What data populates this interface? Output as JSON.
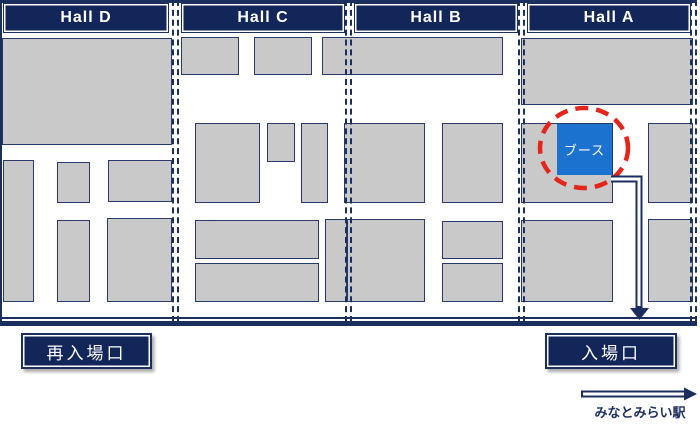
{
  "colors": {
    "navy": "#1b2f5e",
    "navy_fill": "#13265a",
    "booth_gray": "#c9c9c9",
    "booth_border": "#28396b",
    "highlight_blue": "#1c73cf",
    "highlight_red": "#e4251c"
  },
  "halls": [
    {
      "id": "hall-d",
      "label": "Hall D",
      "band": {
        "x": 3,
        "y": 3,
        "w": 166,
        "h": 30
      }
    },
    {
      "id": "hall-c",
      "label": "Hall C",
      "band": {
        "x": 181,
        "y": 3,
        "w": 164,
        "h": 30
      }
    },
    {
      "id": "hall-b",
      "label": "Hall B",
      "band": {
        "x": 354,
        "y": 3,
        "w": 164,
        "h": 30
      }
    },
    {
      "id": "hall-a",
      "label": "Hall A",
      "band": {
        "x": 527,
        "y": 3,
        "w": 164,
        "h": 30
      }
    }
  ],
  "booths": [
    {
      "x": 2,
      "y": 38,
      "w": 170,
      "h": 107
    },
    {
      "x": 3,
      "y": 160,
      "w": 31,
      "h": 142
    },
    {
      "x": 57,
      "y": 162,
      "w": 33,
      "h": 41
    },
    {
      "x": 57,
      "y": 220,
      "w": 33,
      "h": 82
    },
    {
      "x": 108,
      "y": 160,
      "w": 64,
      "h": 42
    },
    {
      "x": 107,
      "y": 218,
      "w": 65,
      "h": 84
    },
    {
      "x": 181,
      "y": 37,
      "w": 58,
      "h": 38
    },
    {
      "x": 254,
      "y": 37,
      "w": 58,
      "h": 38
    },
    {
      "x": 322,
      "y": 37,
      "w": 181,
      "h": 38
    },
    {
      "x": 195,
      "y": 123,
      "w": 65,
      "h": 80
    },
    {
      "x": 267,
      "y": 123,
      "w": 28,
      "h": 39
    },
    {
      "x": 301,
      "y": 123,
      "w": 27,
      "h": 80
    },
    {
      "x": 195,
      "y": 220,
      "w": 124,
      "h": 39
    },
    {
      "x": 195,
      "y": 263,
      "w": 124,
      "h": 39
    },
    {
      "x": 325,
      "y": 219,
      "w": 22,
      "h": 83
    },
    {
      "x": 344,
      "y": 123,
      "w": 81,
      "h": 80
    },
    {
      "x": 442,
      "y": 123,
      "w": 61,
      "h": 80
    },
    {
      "x": 347,
      "y": 219,
      "w": 78,
      "h": 83
    },
    {
      "x": 442,
      "y": 221,
      "w": 61,
      "h": 38
    },
    {
      "x": 442,
      "y": 263,
      "w": 61,
      "h": 39
    },
    {
      "x": 521,
      "y": 38,
      "w": 172,
      "h": 67
    },
    {
      "x": 521,
      "y": 123,
      "w": 92,
      "h": 80
    },
    {
      "x": 648,
      "y": 123,
      "w": 45,
      "h": 80
    },
    {
      "x": 521,
      "y": 220,
      "w": 92,
      "h": 82
    },
    {
      "x": 648,
      "y": 219,
      "w": 45,
      "h": 83
    }
  ],
  "highlight_booth": {
    "label": "ブース",
    "x": 557,
    "y": 124,
    "w": 55,
    "h": 51
  },
  "red_circle": {
    "cx": 584,
    "cy": 148,
    "rx": 44,
    "ry": 40
  },
  "entrance_labels": [
    {
      "id": "reentry",
      "text": "再入場口",
      "x": 21,
      "y": 333,
      "w": 131,
      "h": 36
    },
    {
      "id": "entry",
      "text": "入場口",
      "x": 545,
      "y": 333,
      "w": 132,
      "h": 36
    }
  ],
  "station": {
    "text": "みなとみらい駅",
    "rect": {
      "x": 578,
      "y": 402,
      "w": 124,
      "h": 16
    }
  }
}
